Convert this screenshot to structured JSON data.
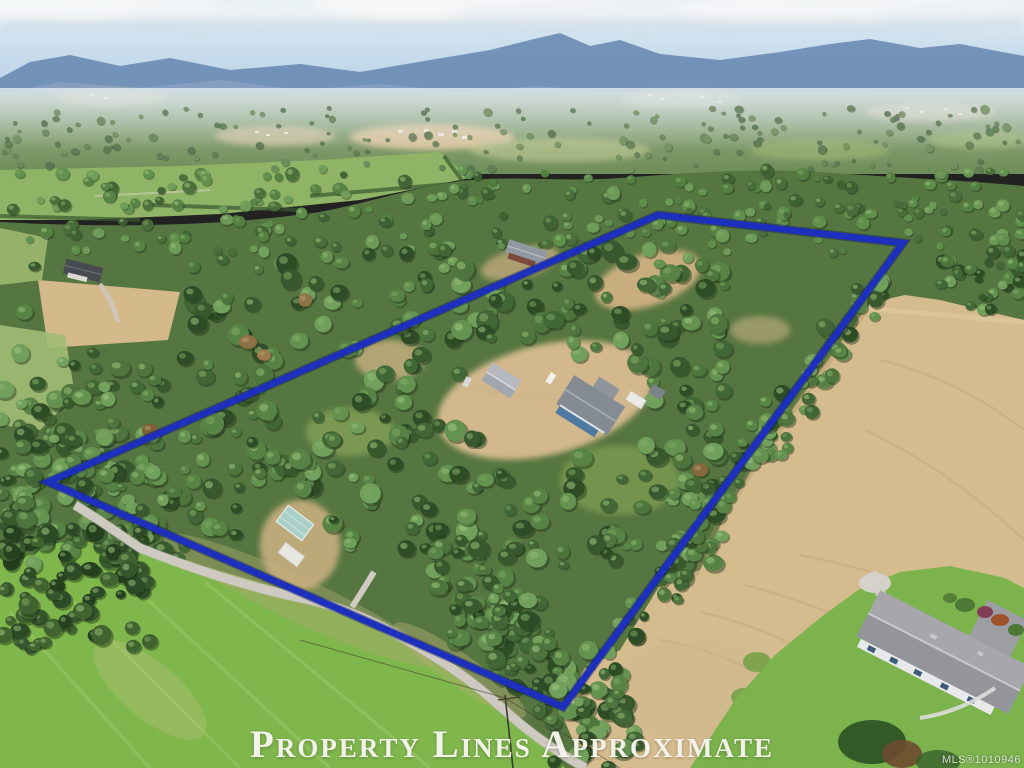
{
  "photo": {
    "kind": "aerial-drone-photo",
    "subject": "treed rural acreage with marked property boundary, farm fields, country road, distant mountains",
    "caption": "Property Lines Approximate",
    "watermark": "MLS®1010946"
  },
  "boundary": {
    "label": "approximate property boundary overlay",
    "points": "48,482 658,215 903,243 563,707",
    "color": "#1d30bd"
  },
  "palette": {
    "sky": "#c5daeb",
    "clouds": "#f3f5f6",
    "mountains_far": "#6f8eb5",
    "mountains_near": "#87a0c0",
    "valley_haze": "#9db285",
    "forest": "#567641",
    "field_tan": "#d5bc8e",
    "lawn_green": "#80b74c",
    "road_gray": "#d4d0c7",
    "caption_color": "#f7f5ef"
  }
}
